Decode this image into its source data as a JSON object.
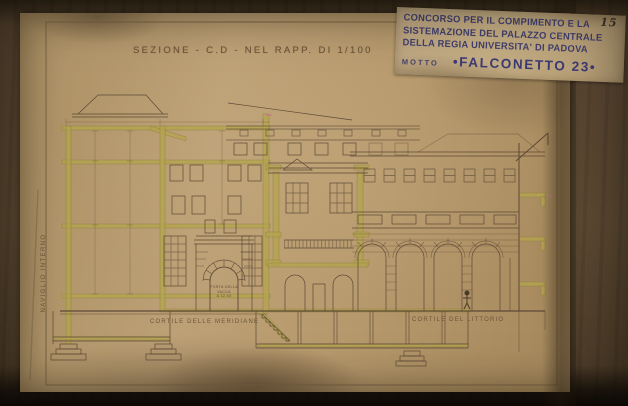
{
  "sheet": {
    "title": "SEZIONE - C.D - NEL RAPP. DI 1/100",
    "labels": {
      "courtyard_left": "CORTILE DELLE MERIDIANE",
      "courtyard_right": "CORTILE DEL LITTORIO",
      "canal": "NAVIGLIO INTERNO",
      "portal_line1": "PORTA DELLA",
      "portal_line2": "VACCA",
      "portal_line3": "A 12.43"
    }
  },
  "card": {
    "line1": "CONCORSO PER IL COMPIMENTO E LA",
    "line2": "SISTEMAZIONE DEL PALAZZO CENTRALE",
    "line3": "DELLA REGIA UNIVERSITA' DI PADOVA",
    "motto_label": "MOTTO",
    "motto_value": "•FALCONETTO 23•",
    "corner_number": "15"
  },
  "colors": {
    "paper": "#b6996c",
    "ink": "#5d4936",
    "highlight": "#b3a44e",
    "card_ink": "#403d6e",
    "mount": "#55432b"
  }
}
